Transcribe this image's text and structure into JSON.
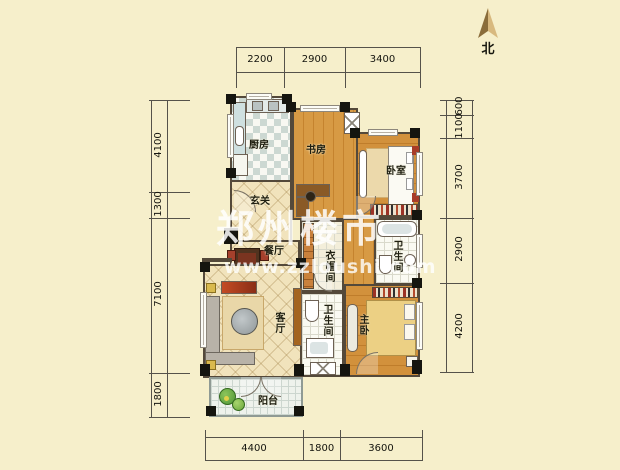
{
  "compass": {
    "label": "北"
  },
  "watermark": {
    "title": "郑州楼市",
    "url": "www.zzloushi.com"
  },
  "dimensions": {
    "top": [
      "2200",
      "2900",
      "3400"
    ],
    "left": [
      "4100",
      "1300",
      "7100",
      "1800"
    ],
    "right": [
      "600",
      "1100",
      "3700",
      "2900",
      "4200"
    ],
    "bottom": [
      "4400",
      "1800",
      "3600"
    ]
  },
  "rooms": {
    "kitchen": "厨房",
    "entry": "玄关",
    "study": "书房",
    "bedroom": "卧室",
    "dining": "餐厅",
    "cloakroom": "衣帽间",
    "bath_upper": "卫生间",
    "bath_lower": "卫生间",
    "living": "客厅",
    "master": "主卧",
    "balcony": "阳台"
  },
  "colors": {
    "background": "#f6efcb",
    "wood": "#d0903c",
    "wall": "#54493a",
    "accent_red": "#a83c28",
    "watermark": "#ffffff"
  }
}
